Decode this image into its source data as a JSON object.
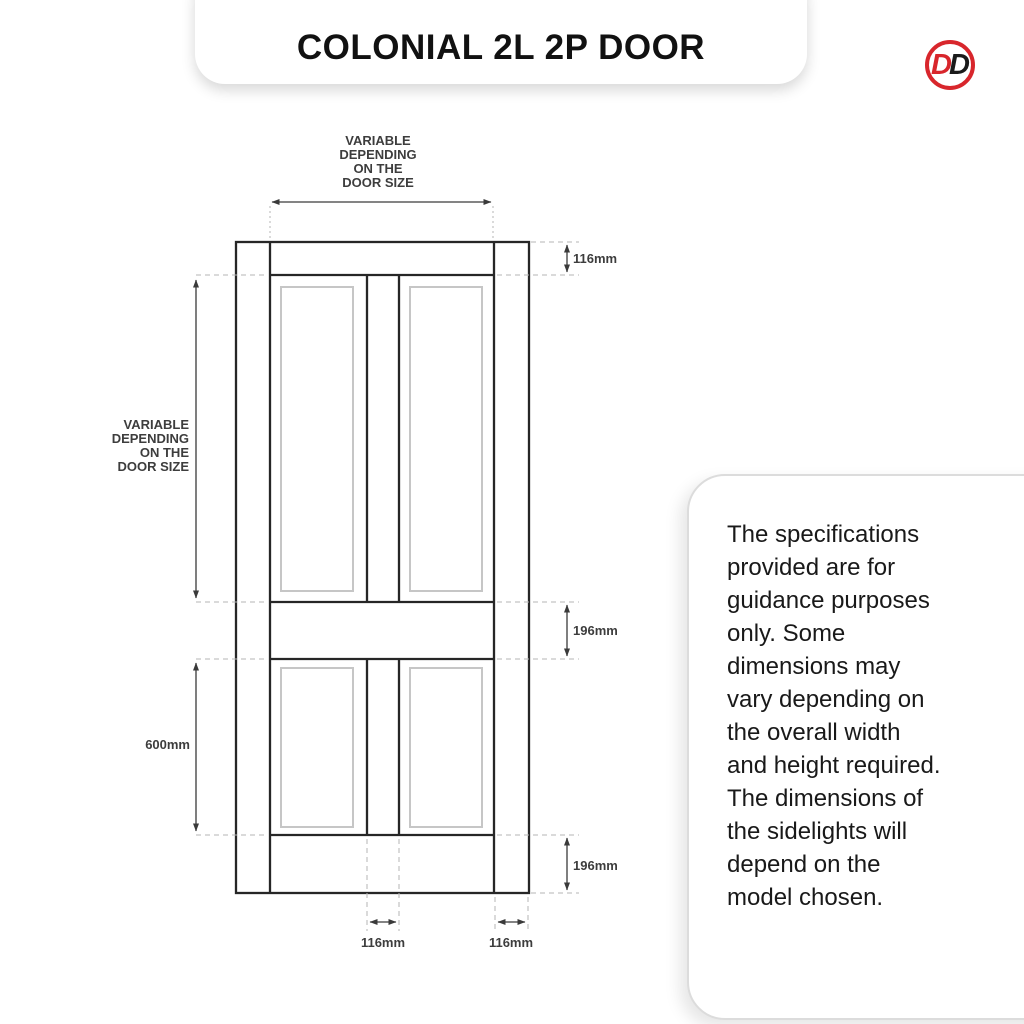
{
  "header": {
    "title": "COLONIAL 2L 2P DOOR"
  },
  "logo": {
    "letter_1": "D",
    "letter_2": "D",
    "ring_color": "#d8262c",
    "letter_1_color": "#d8262c",
    "letter_2_color": "#1a1a1a"
  },
  "diagram": {
    "width_label": {
      "lines": [
        "VARIABLE",
        "DEPENDING",
        "ON THE",
        "DOOR SIZE"
      ]
    },
    "height_label": {
      "lines": [
        "VARIABLE",
        "DEPENDING",
        "ON THE",
        "DOOR SIZE"
      ]
    },
    "dimensions": {
      "top_rail_height": "116mm",
      "middle_rail_height": "196mm",
      "bottom_rail_height": "196mm",
      "bottom_panel_height": "600mm",
      "center_stile_width": "116mm",
      "outer_stile_width": "116mm"
    },
    "colors": {
      "door_line": "#262626",
      "dimension_line": "#3a3a3a",
      "guide_line": "#b5b5b5",
      "panel_moulding_line": "#c6c6c6",
      "label_text": "#3d3d3d"
    }
  },
  "note": {
    "lines": [
      "The specifications",
      "provided are for",
      "guidance purposes",
      "only. Some",
      "dimensions may",
      "vary depending on",
      "the overall width",
      "and height required.",
      "The dimensions of",
      "the sidelights will",
      "depend on the",
      "model chosen."
    ]
  }
}
